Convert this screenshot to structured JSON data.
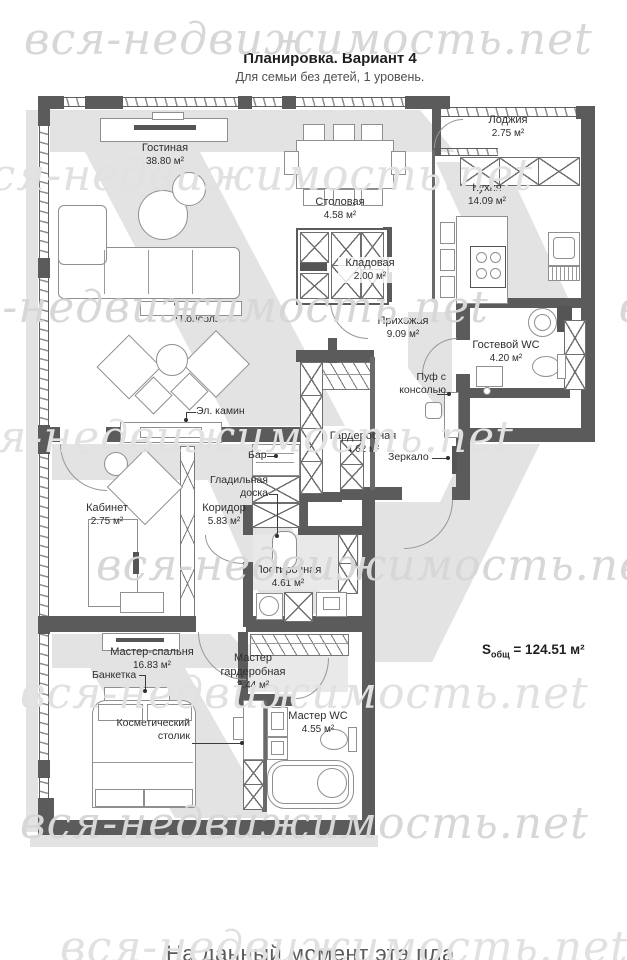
{
  "title": "Планировка. Вариант 4",
  "subtitle": "Для семьи без детей, 1 уровень.",
  "watermark": "вся-недвижимость.net",
  "total_area_prefix": "S",
  "total_area_sub": "общ",
  "total_area_value": " = 124.51 м²",
  "bottom_caption": "На данный момент эта пла",
  "rooms": [
    {
      "name": "Лоджия",
      "area": "2.75 м²"
    },
    {
      "name": "Гостиная",
      "area": "38.80 м²"
    },
    {
      "name": "Столовая",
      "area": "4.58 м²"
    },
    {
      "name": "Кухня",
      "area": "14.09 м²"
    },
    {
      "name": "Кладовая",
      "area": "2.00 м²"
    },
    {
      "name": "Прихожая",
      "area": "9.09 м²"
    },
    {
      "name": "Гостевой WC",
      "area": "4.20 м²"
    },
    {
      "name": "Гардеробная",
      "area": "4.62 м²"
    },
    {
      "name": "Кабинет",
      "area": "2.75 м²"
    },
    {
      "name": "Коридор",
      "area": "5.83 м²"
    },
    {
      "name": "Постирочная",
      "area": "4.61 м²"
    },
    {
      "name": "Мастер-спальня",
      "area": "16.83 м²"
    },
    {
      "name": "Мастер гардеробная",
      "area": "3.44 м²"
    },
    {
      "name": "Мастер WC",
      "area": "4.55 м²"
    }
  ],
  "annotations": {
    "console": "Консоль",
    "fireplace": "Эл. камин",
    "bar": "Бар",
    "ironing_line1": "Гладильная",
    "ironing_line2": "доска",
    "pouf_line1": "Пуф с",
    "pouf_line2": "консолью",
    "mirror": "Зеркало",
    "bench": "Банкетка",
    "vanity_line1": "Косметический",
    "vanity_line2": "столик"
  }
}
